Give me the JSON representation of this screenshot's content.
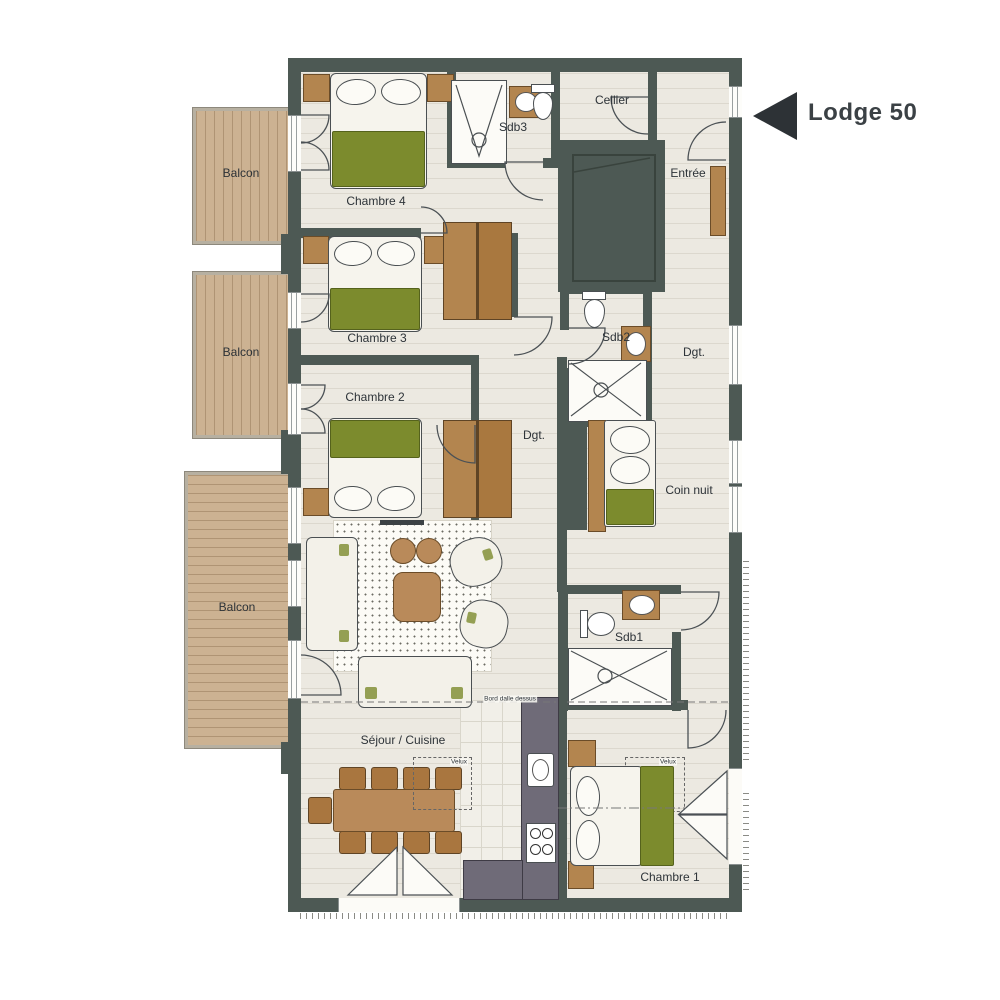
{
  "title": "Lodge 50",
  "rooms": {
    "balcon_top": "Balcon",
    "balcon_middle": "Balcon",
    "balcon_bottom": "Balcon",
    "chambre4": "Chambre 4",
    "chambre3": "Chambre 3",
    "chambre2": "Chambre 2",
    "chambre1": "Chambre 1",
    "sdb3": "Sdb3",
    "sdb2": "Sdb2",
    "sdb1": "Sdb1",
    "cellier": "Cellier",
    "entree": "Entrée",
    "dgt_upper": "Dgt.",
    "dgt_middle": "Dgt.",
    "coin_nuit": "Coin nuit",
    "sejour_cuisine": "Séjour / Cuisine"
  },
  "annotations": {
    "bord_dalle": "Bord dalle dessus",
    "velux_sejour": "Velux",
    "velux_chambre1": "Velux"
  },
  "colors": {
    "wall": "#4d5954",
    "floor": "#ece9e1",
    "balcony_wood": "#ccb292",
    "bed_green": "#7c8b2d",
    "furniture_brown": "#b3854f",
    "kitchen_counter": "#6f6b78",
    "label_ink": "#2d3338",
    "title_ink": "#3b4145"
  }
}
